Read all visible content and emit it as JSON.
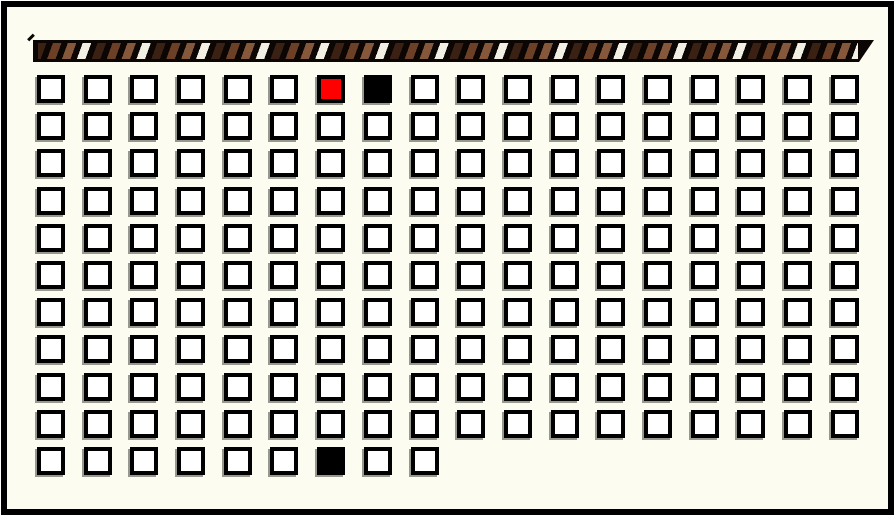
{
  "panel": {
    "background_color": "#FCFCF0",
    "frame_color": "#000000"
  },
  "decorative_bar": {
    "kind": "diagonal-striped-rope-border",
    "base_color": "#0B0603",
    "stripe_colors": [
      "#3A2113",
      "#6B4027",
      "#86583B",
      "#F2EFE5"
    ]
  },
  "grid": {
    "columns": 18,
    "total_rows": 11,
    "full_rows": 10,
    "last_row_columns": 9,
    "cell_colors": {
      "fill": "#FFFFFF",
      "border": "#000000",
      "shadow": "#98988E",
      "red": "#FF0000",
      "black": "#000000"
    },
    "marked_cells": [
      {
        "row": 1,
        "col": 7,
        "color": "red"
      },
      {
        "row": 1,
        "col": 8,
        "color": "black"
      },
      {
        "row": 11,
        "col": 7,
        "color": "black"
      }
    ]
  }
}
